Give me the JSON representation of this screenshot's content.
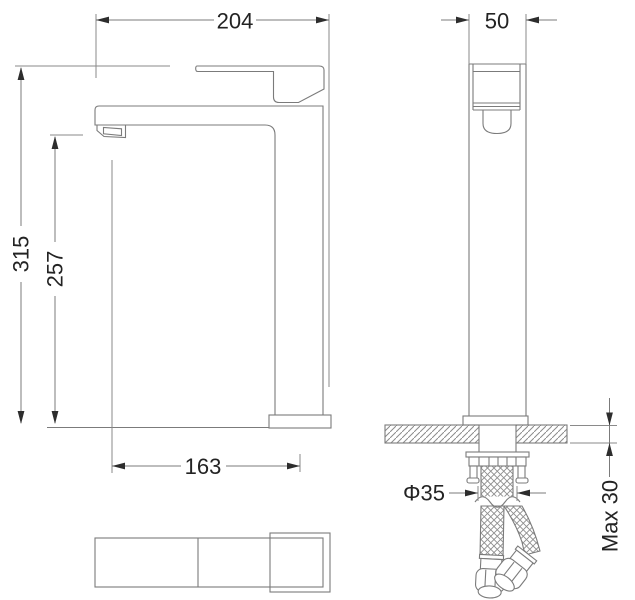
{
  "colors": {
    "background": "#ffffff",
    "line": "#7b7b7b",
    "text": "#232323",
    "arrow": "#2d2d2d"
  },
  "dimensions": {
    "spout_width": "204",
    "body_width": "50",
    "overall_height": "315",
    "spout_height": "257",
    "spout_reach": "163",
    "shank_diameter": "Φ35",
    "max_thickness": "Max 30"
  }
}
